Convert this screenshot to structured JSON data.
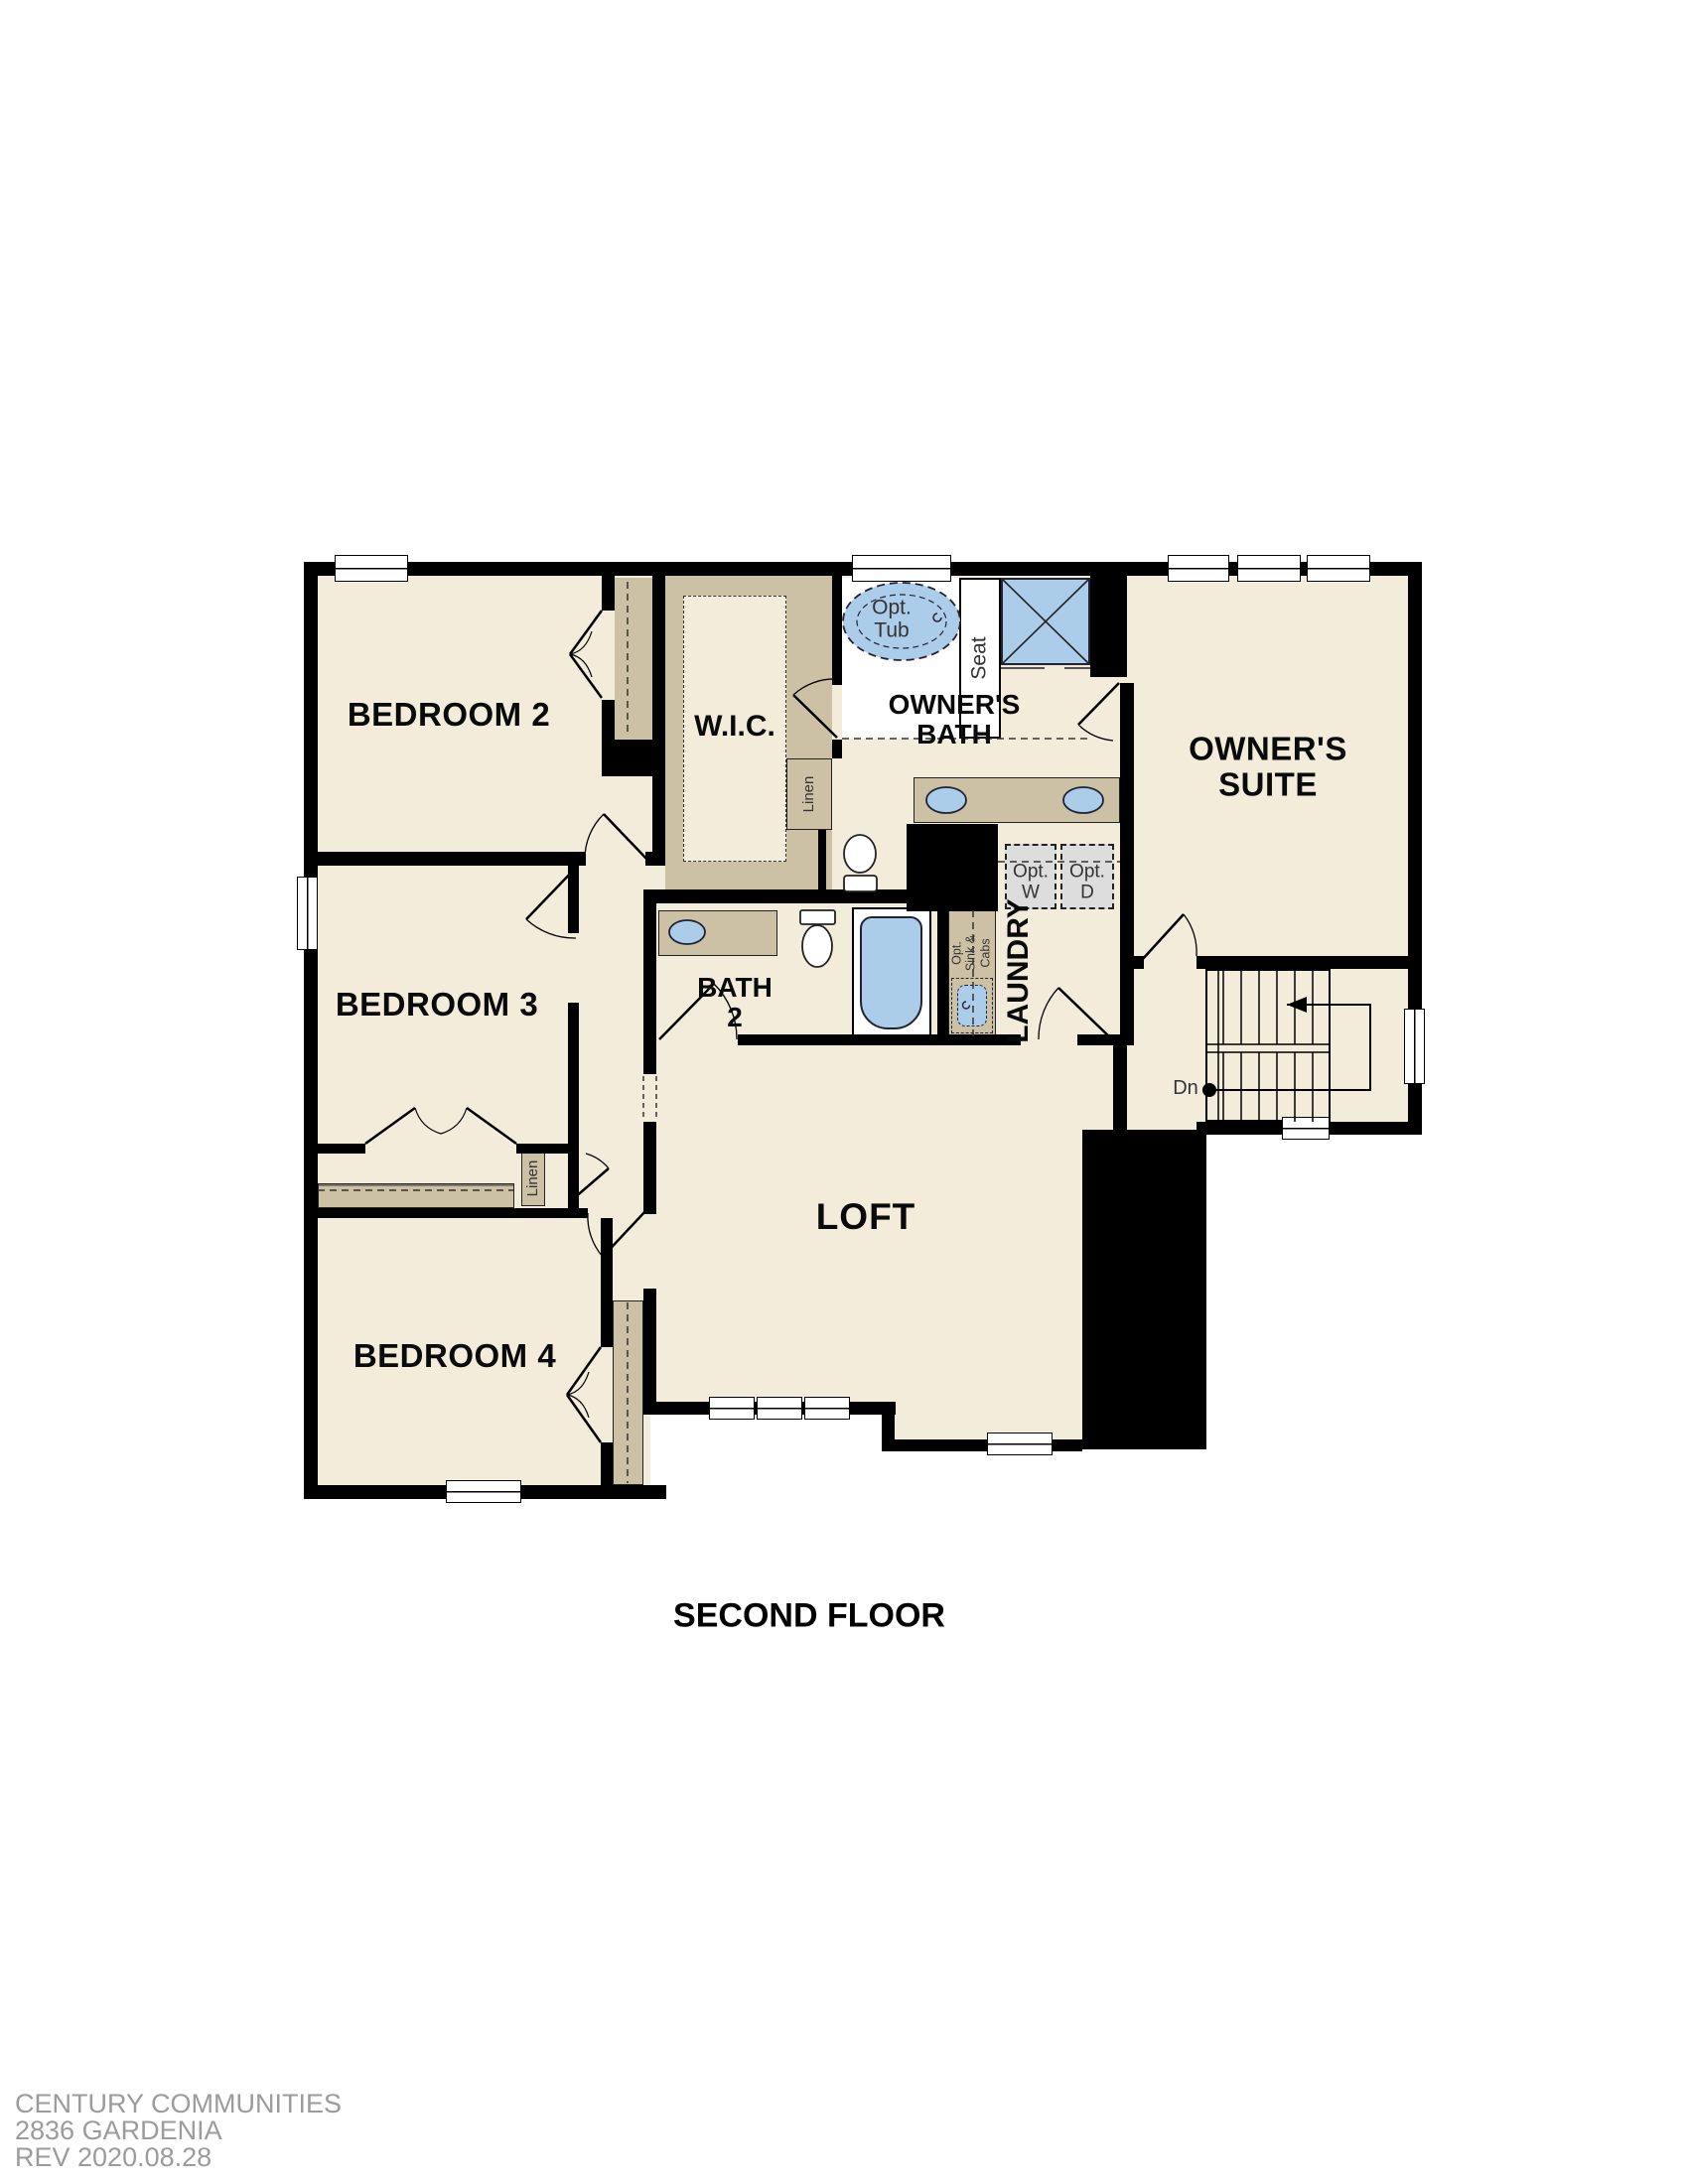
{
  "title": "SECOND FLOOR",
  "footer": {
    "line1": "CENTURY COMMUNITIES",
    "line2": "2836 GARDENIA",
    "line3": "REV 2020.08.28"
  },
  "rooms": {
    "bedroom2": "BEDROOM 2",
    "bedroom3": "BEDROOM 3",
    "bedroom4": "BEDROOM 4",
    "wic": "W.I.C.",
    "owners_bath_line1": "OWNER'S",
    "owners_bath_line2": "BATH",
    "owners_suite_line1": "OWNER'S",
    "owners_suite_line2": "SUITE",
    "loft": "LOFT",
    "bath2_line1": "BATH",
    "bath2_line2": "2",
    "laundry": "LAUNDRY"
  },
  "fixtures": {
    "opt_tub_line1": "Opt.",
    "opt_tub_line2": "Tub",
    "seat": "Seat",
    "linen_wic": "Linen",
    "linen_hall": "Linen",
    "opt_w_line1": "Opt.",
    "opt_w_line2": "W",
    "opt_d_line1": "Opt.",
    "opt_d_line2": "D",
    "opt_sink_line1": "Opt.",
    "opt_sink_line2": "Sink &",
    "opt_sink_line3": "Cabs"
  },
  "stairs": {
    "down_label": "Dn"
  },
  "colors": {
    "floor": "#f3ecdb",
    "tan": "#cdc1a5",
    "blue": "#abcdea",
    "appliance": "#dddddd",
    "wall": "#000000",
    "footer": "#9b9b9b"
  }
}
